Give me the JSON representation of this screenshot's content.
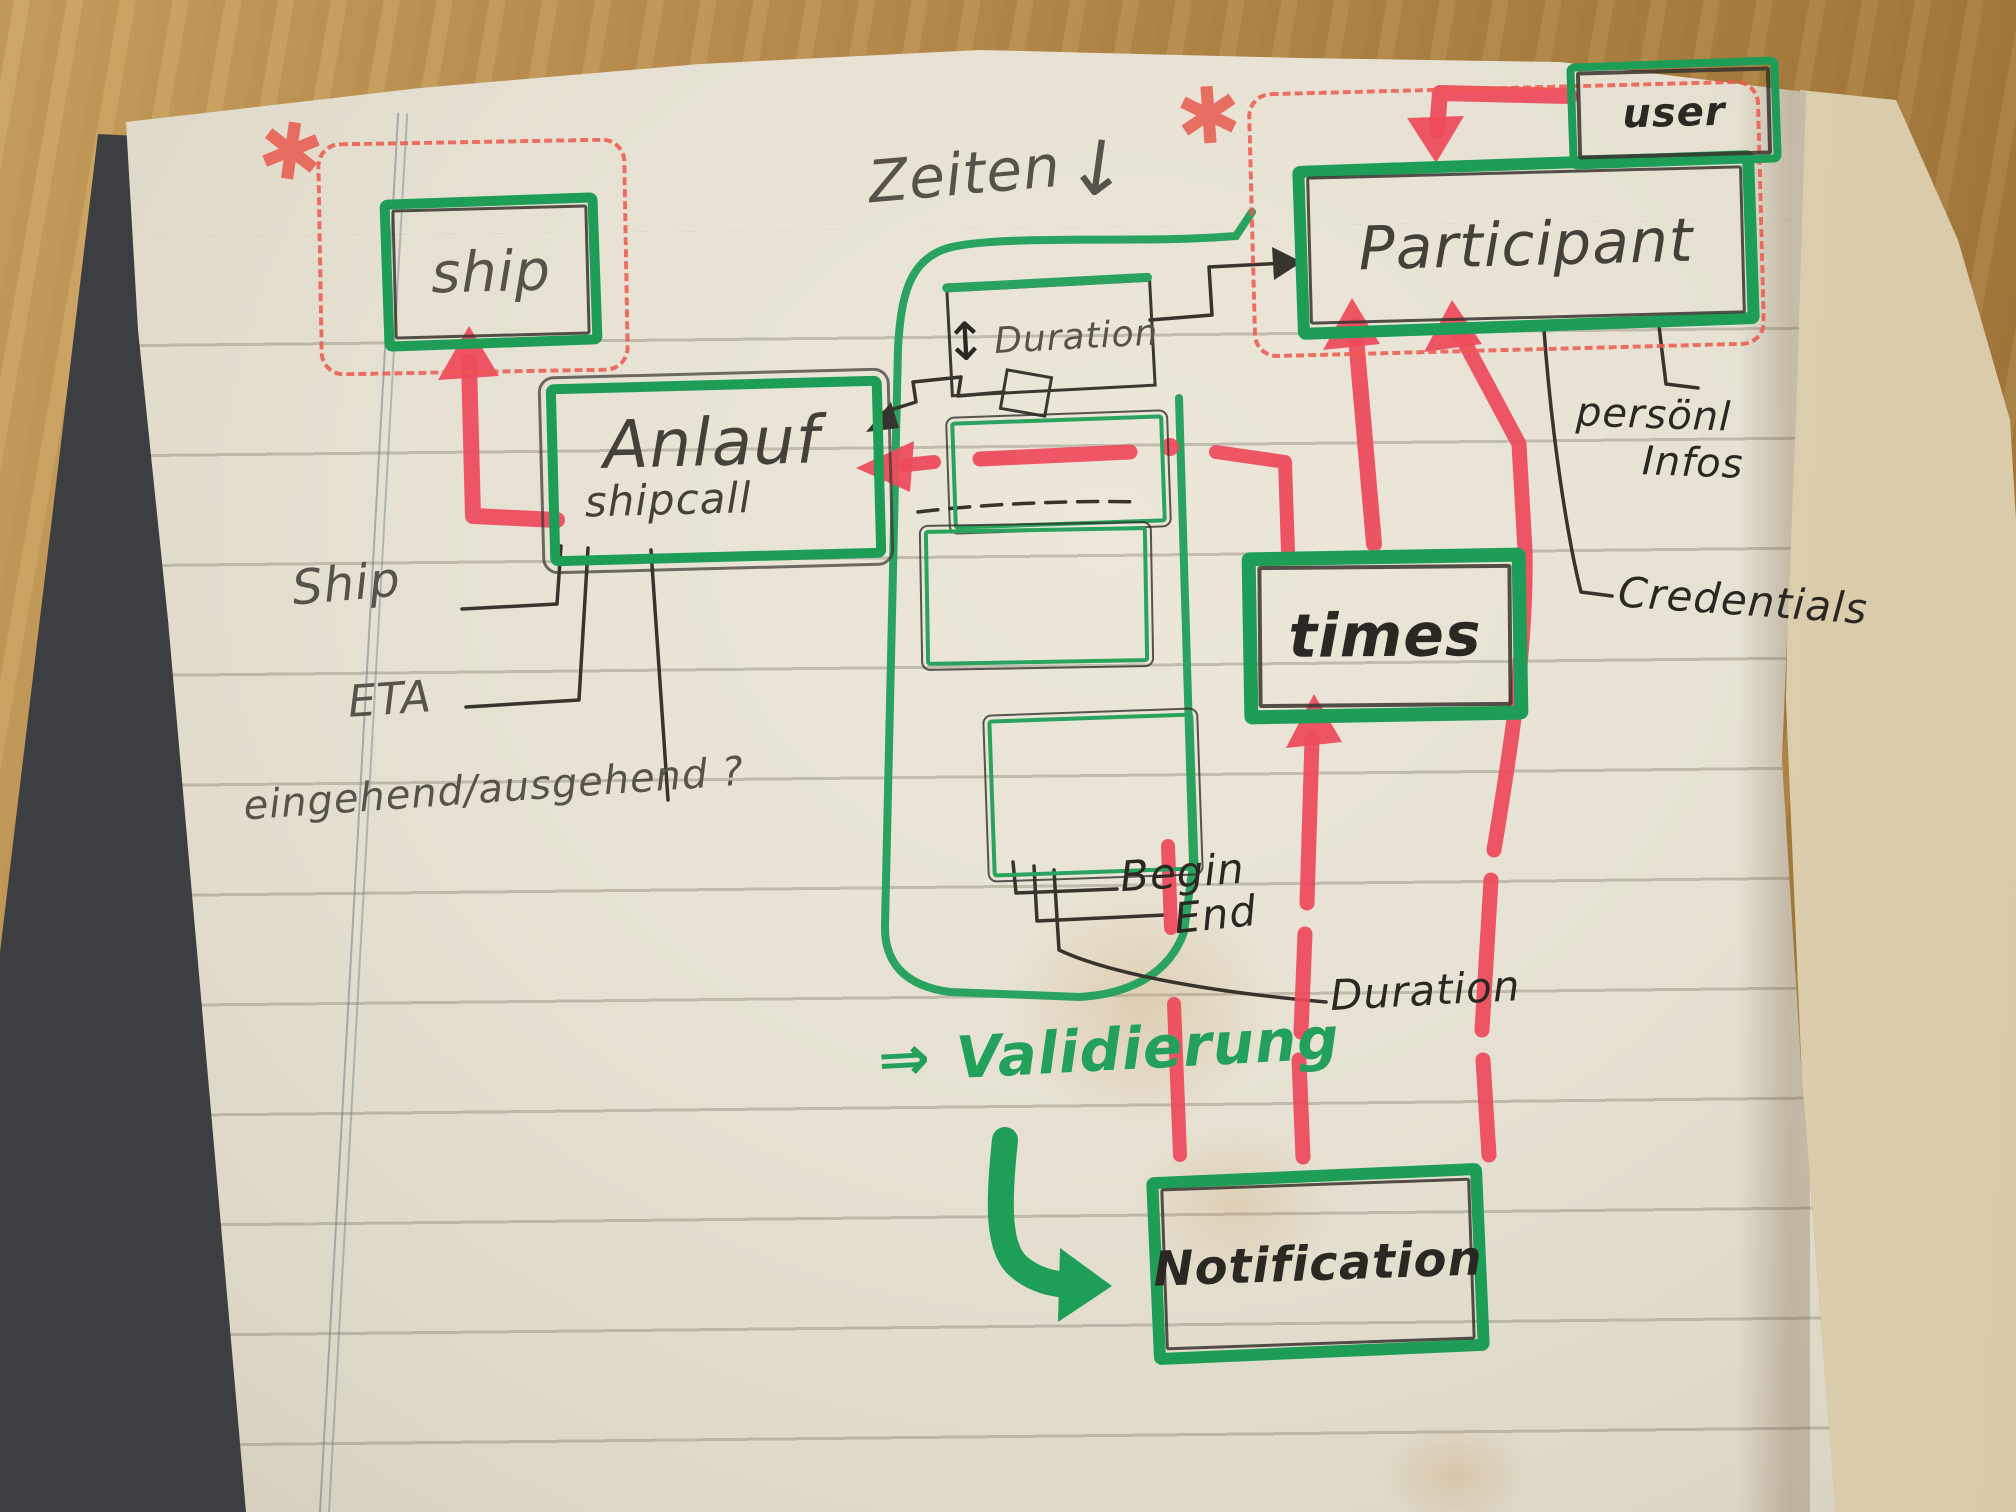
{
  "page": {
    "boxes": {
      "ship": "ship",
      "anlauf": "Anlauf",
      "anlauf_sub": "shipcall",
      "participant": "Participant",
      "user": "user",
      "times": "times",
      "duration": "Duration",
      "notification": "Notification"
    },
    "labels": {
      "zeiten": "Zeiten",
      "zeiten_arrow": "↓",
      "updown_arrow": "↕",
      "asterisk": "✱",
      "ship_attr": "Ship",
      "eta": "ETA",
      "in_out": "eingehend/ausgehend ?",
      "begin": "Begin",
      "end": "End",
      "duration_attr": "Duration",
      "personal1": "persönl",
      "personal2": "Infos",
      "credentials": "Credentials",
      "validierung_arrow": "⇒",
      "validierung": "Validierung"
    },
    "colors": {
      "marker_green": "#1d9d56",
      "pen_green": "#2aa260",
      "marker_red": "#ee4a5b",
      "dashed_red": "#ee5a4d",
      "pen_black": "#38342d",
      "pencil_gray": "#57534b"
    }
  }
}
